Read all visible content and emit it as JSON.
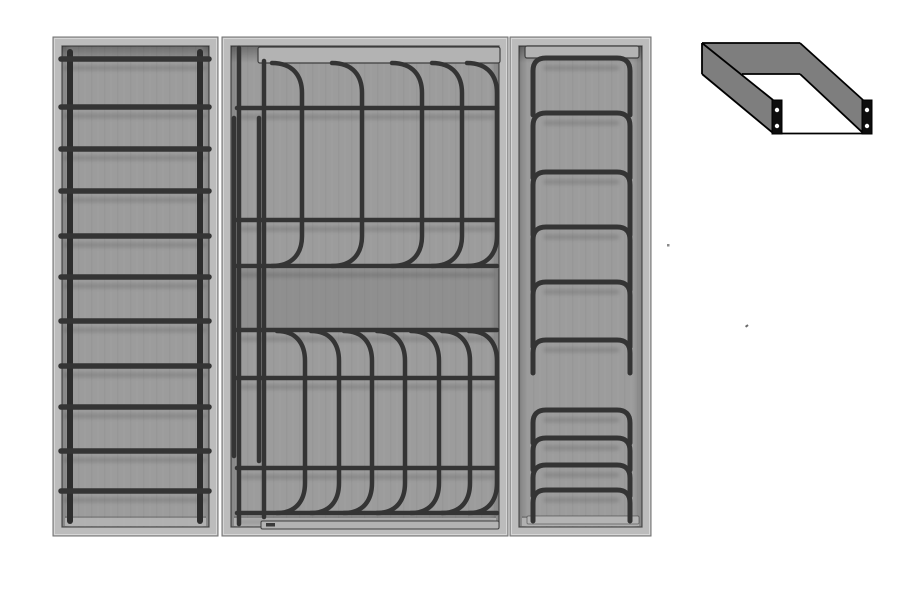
{
  "canvas": {
    "width": 916,
    "height": 600,
    "background": "#ffffff"
  },
  "colors": {
    "tray_face": "#bcbcbc",
    "tray_edge": "#6f6f6f",
    "tray_highlight": "#dcdcdc",
    "interior": "#9c9c9c",
    "crease": "#4f4f4f",
    "ledge": "#b4b4b4",
    "wire": "#343434",
    "wire_rail": "#2d2d2d",
    "rail_fill": "#b3b3b3",
    "rail_stroke": "#3f3f3f",
    "bracket_fill": "#7e7e7e",
    "bracket_line": "#000000",
    "plate_fill": "#0d0d0d",
    "hole_fill": "#ffffff",
    "shadow": "rgba(0,0,0,0.12)"
  },
  "trays": [
    {
      "name": "bottle-rack-insert",
      "x": 53,
      "y": 37,
      "w": 165,
      "h": 499,
      "rim": 9
    },
    {
      "name": "plate-rack-insert",
      "x": 222,
      "y": 37,
      "w": 286,
      "h": 499,
      "rim": 9
    },
    {
      "name": "plate-holder-insert",
      "x": 510,
      "y": 37,
      "w": 141,
      "h": 499,
      "rim": 9
    }
  ],
  "ladder": {
    "name": "ladder-rack-wireframe",
    "rails_x": [
      70,
      200
    ],
    "rail_top": 52,
    "rail_bottom": 521,
    "rail_width": 6,
    "rung_y": [
      59,
      107,
      149,
      191,
      236,
      277,
      321,
      366,
      407,
      451,
      491
    ],
    "rung_x1": 61,
    "rung_x2": 209,
    "rung_width": 5.5
  },
  "plate_rack": {
    "name": "plate-rack-wireframe",
    "top_rail": {
      "x": 258,
      "y": 47,
      "w": 242,
      "h": 16
    },
    "bottom_rail": {
      "x": 261,
      "y": 521,
      "w": 238,
      "h": 8
    },
    "bottom_tab": {
      "x": 266,
      "y": 523,
      "w": 9,
      "h": 3.5
    },
    "verticals": [
      {
        "x": 239,
        "y1": 48,
        "y2": 524
      },
      {
        "x": 264,
        "y1": 61,
        "y2": 517
      },
      {
        "x": 234,
        "y1": 118,
        "y2": 456
      },
      {
        "x": 259,
        "y1": 118,
        "y2": 461
      }
    ],
    "h_wire_x1": 237,
    "h_wire_x2": 497,
    "h_wires_y": [
      108,
      220,
      266,
      330,
      378,
      468,
      513
    ],
    "shade_band": {
      "x": 233,
      "y": 269,
      "w": 266,
      "h": 60
    },
    "top_arches": {
      "verticals_x": [
        302,
        362,
        422,
        462,
        497
      ],
      "stub": 30,
      "y_top": 63,
      "y_bottom": 266
    },
    "bottom_arches": {
      "verticals_x": [
        305,
        339,
        372,
        405,
        439,
        470,
        497
      ],
      "stub": 28,
      "y_top": 331,
      "y_bottom": 513
    },
    "wire_width": 4.5
  },
  "stack_rack": {
    "name": "stacked-hoops-wireframe",
    "top_rail": {
      "x": 525,
      "y": 46,
      "w": 114,
      "h": 12
    },
    "bottom_ledge": {
      "x": 527,
      "y": 516,
      "w": 112,
      "h": 8
    },
    "hoop_x_left": 533,
    "hoop_x_right": 630,
    "hoop_radius": 13,
    "hoops": [
      {
        "bar_y": 58,
        "leg": 44
      },
      {
        "bar_y": 113,
        "leg": 52
      },
      {
        "bar_y": 172,
        "leg": 50
      },
      {
        "bar_y": 227,
        "leg": 50
      },
      {
        "bar_y": 282,
        "leg": 52
      },
      {
        "bar_y": 340,
        "leg": 20
      },
      {
        "bar_y": 410,
        "leg": 20
      },
      {
        "bar_y": 438,
        "leg": 19
      },
      {
        "bar_y": 465,
        "leg": 18
      },
      {
        "bar_y": 490,
        "leg": 18
      }
    ],
    "wire_width": 5
  },
  "bracket": {
    "name": "u-channel-bracket-drawing",
    "line_width": 1.8,
    "hole_radius": 2.2,
    "walls": [
      {
        "name": "back-wall",
        "points": "702,43 800,43 800,74 702,74"
      },
      {
        "name": "left-wall",
        "points": "702,43 773,100 773,133 702,74"
      },
      {
        "name": "right-wall",
        "points": "800,43 863,100 863,133 800,74"
      }
    ],
    "outline": [
      [
        702,
        43,
        800,
        43
      ],
      [
        702,
        43,
        702,
        74
      ],
      [
        742,
        74,
        800,
        74
      ],
      [
        702,
        43,
        773,
        100
      ],
      [
        702,
        74,
        773,
        133
      ],
      [
        800,
        43,
        863,
        100
      ],
      [
        800,
        74,
        863,
        133
      ],
      [
        782,
        133.5,
        862,
        133.5
      ]
    ],
    "plates": [
      {
        "name": "left-end-plate",
        "x": 772,
        "y": 100,
        "w": 10,
        "h": 34,
        "holes": [
          [
            777,
            110
          ],
          [
            777,
            126
          ]
        ]
      },
      {
        "name": "right-end-plate",
        "x": 862,
        "y": 100,
        "w": 10,
        "h": 34,
        "holes": [
          [
            867,
            110
          ],
          [
            867,
            126
          ]
        ]
      }
    ]
  },
  "specks": [
    {
      "x": 667,
      "y": 244,
      "w": 2.5,
      "h": 2.5,
      "color": "#8a8a8a"
    },
    {
      "x": 745,
      "y": 326,
      "w": 3,
      "h": 2,
      "color": "#6a6a6a"
    }
  ]
}
